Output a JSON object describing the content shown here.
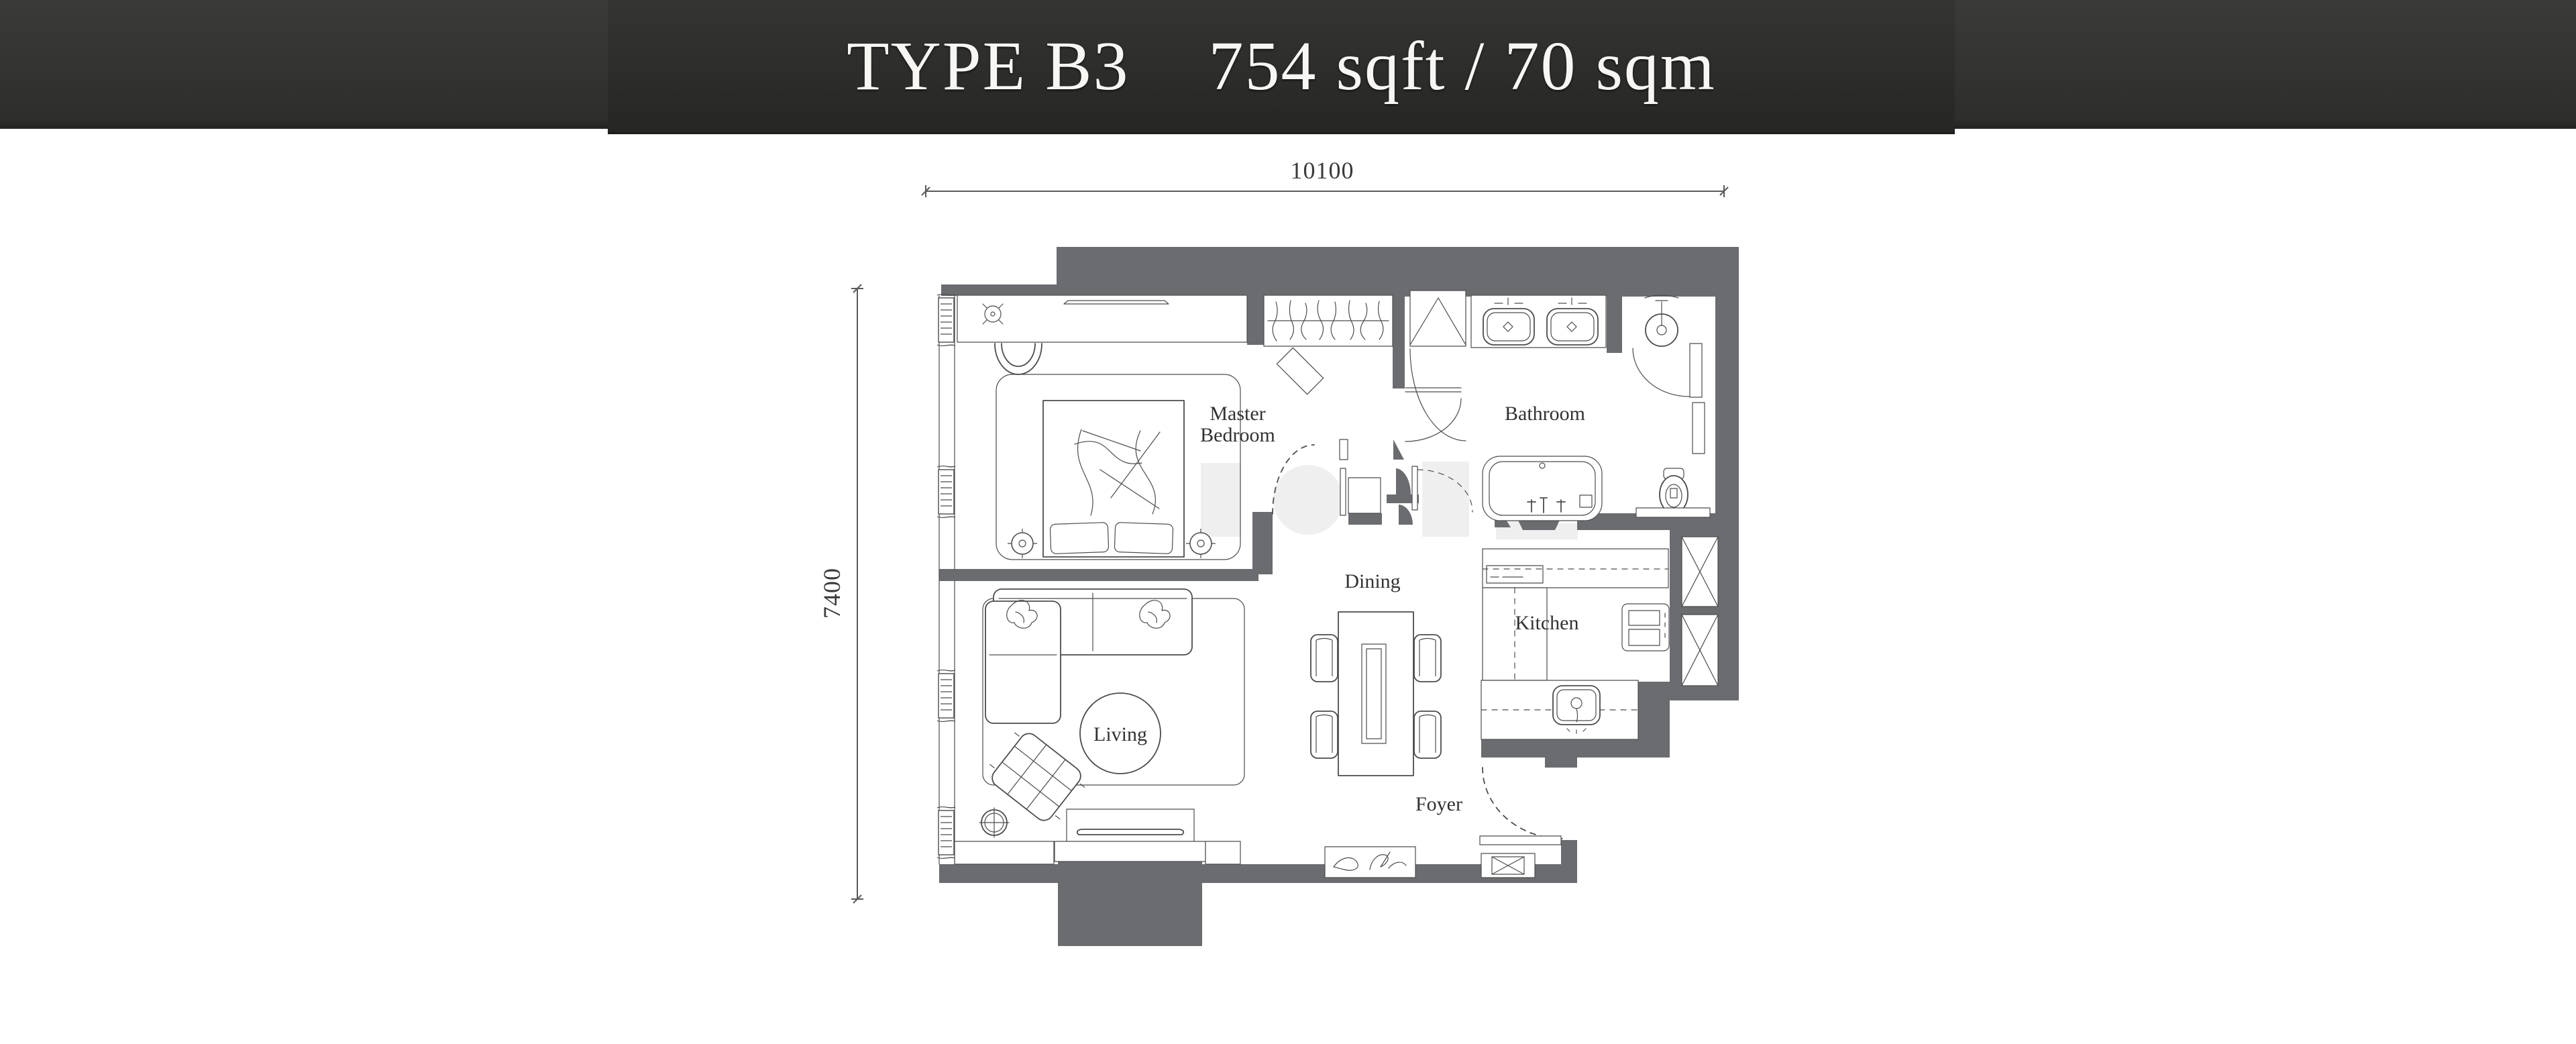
{
  "header": {
    "type_label": "TYPE B3",
    "area_label": "754 sqft / 70 sqm",
    "bar_color": "#333331",
    "panel_color": "#2c2c2a",
    "text_color": "#f7f6f2"
  },
  "dimensions": {
    "top_width": "10100",
    "left_height": "7400"
  },
  "rooms": {
    "master_bedroom_line1": "Master",
    "master_bedroom_line2": "Bedroom",
    "bathroom": "Bathroom",
    "dining": "Dining",
    "kitchen": "Kitchen",
    "living": "Living",
    "foyer": "Foyer"
  },
  "colors": {
    "wall": "#6a6c70",
    "linework": "#4c4c4c",
    "label": "#323232",
    "background": "#ffffff"
  }
}
